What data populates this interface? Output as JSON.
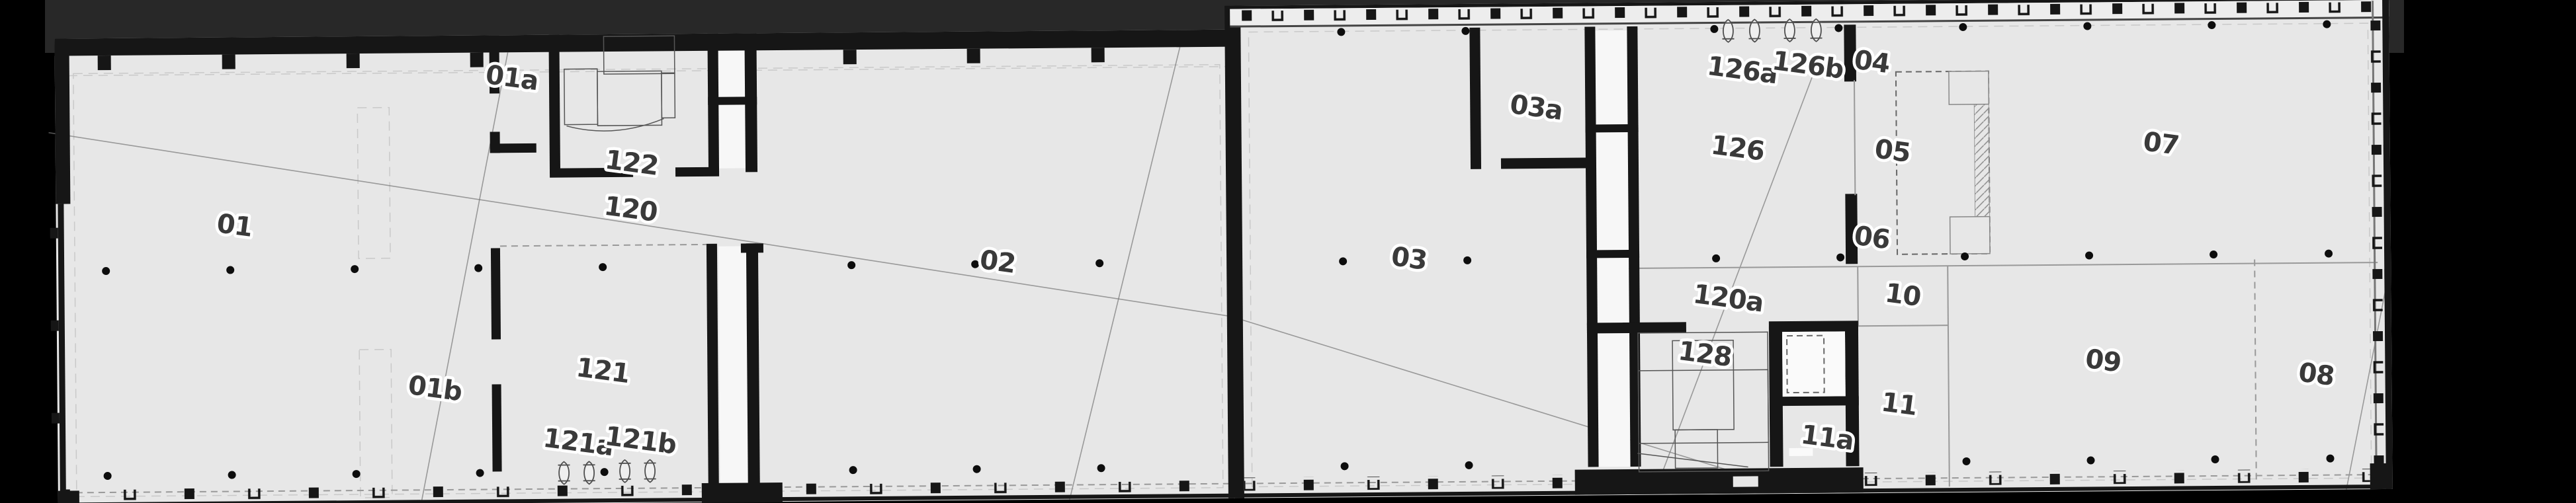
{
  "title": "Architectural floor plan - long two-wing building, room numbering plan",
  "colors": {
    "background": "#000000",
    "top_band": "#282828",
    "paper": "#e7e7e7",
    "wall": "#161616",
    "shaft_white": "#f7f7f7",
    "label_text": "#3a3a3a",
    "label_halo": "#ffffff",
    "thin_line": "#999999",
    "reference_line": "#777777"
  },
  "rooms": [
    {
      "label": "01"
    },
    {
      "label": "01a"
    },
    {
      "label": "01b"
    },
    {
      "label": "122"
    },
    {
      "label": "120"
    },
    {
      "label": "121"
    },
    {
      "label": "121a"
    },
    {
      "label": "121b"
    },
    {
      "label": "02"
    },
    {
      "label": "03"
    },
    {
      "label": "03a"
    },
    {
      "label": "04"
    },
    {
      "label": "05"
    },
    {
      "label": "06"
    },
    {
      "label": "07"
    },
    {
      "label": "08"
    },
    {
      "label": "09"
    },
    {
      "label": "10"
    },
    {
      "label": "11"
    },
    {
      "label": "11a"
    },
    {
      "label": "120a"
    },
    {
      "label": "126"
    },
    {
      "label": "126a"
    },
    {
      "label": "126b"
    },
    {
      "label": "128"
    }
  ]
}
